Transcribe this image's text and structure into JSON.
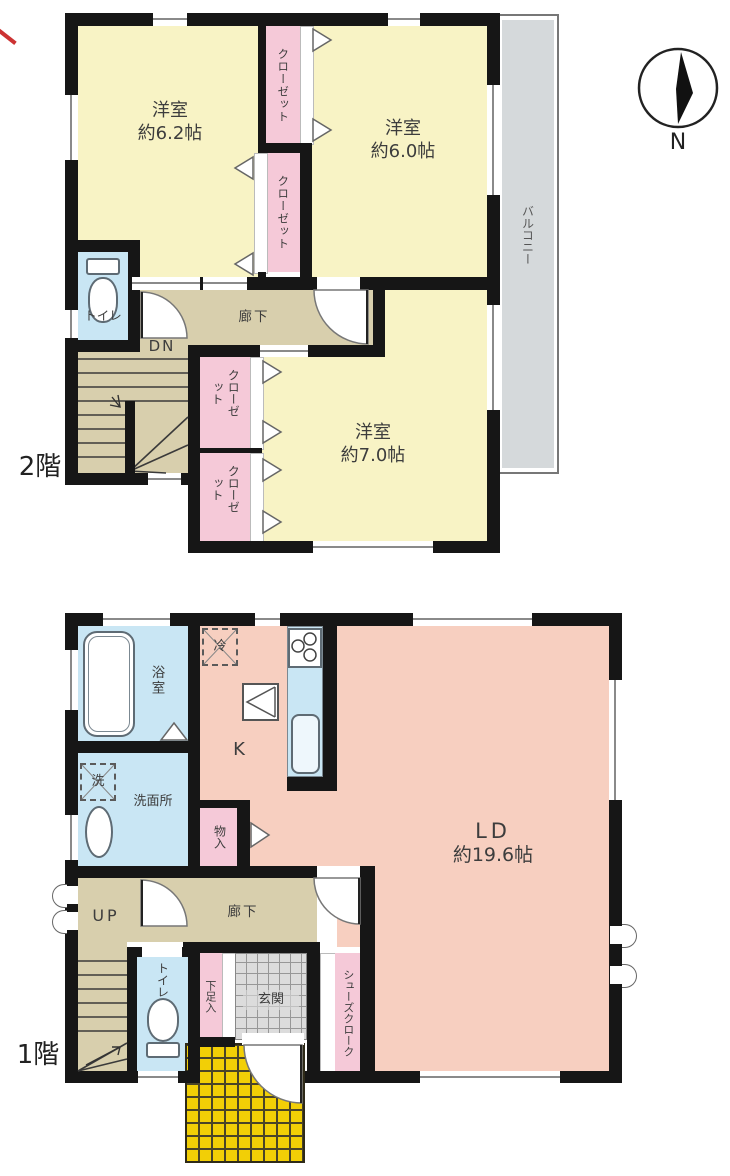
{
  "compass": {
    "label": "N"
  },
  "floor2": {
    "label": "2階",
    "room_62": {
      "name": "洋室",
      "size": "約6.2帖"
    },
    "room_60": {
      "name": "洋室",
      "size": "約6.0帖"
    },
    "room_70": {
      "name": "洋室",
      "size": "約7.0帖"
    },
    "closet_top_1": "クローゼット",
    "closet_top_2": "クローゼット",
    "closet_low_1": "クローゼット",
    "closet_low_2": "クローゼット",
    "toilet": "トイレ",
    "hallway": "廊下",
    "stairs_down": "DN",
    "balcony": "バルコニー"
  },
  "floor1": {
    "label": "1階",
    "bathroom": "浴室",
    "washer": "洗",
    "washroom": "洗面所",
    "fridge": "冷",
    "kitchen": "K",
    "storage": "物入",
    "living": {
      "name": "LD",
      "size": "約19.6帖"
    },
    "stairs_up": "UP",
    "hallway": "廊下",
    "toilet": "トイレ",
    "shoe_box": "下足入",
    "entrance": "玄関",
    "shoe_closet": "シューズクローク"
  },
  "colors": {
    "wall": "#161616",
    "room_yellow": "#f8f3c5",
    "closet_pink": "#f5c9d8",
    "corridor_tan": "#d8cfad",
    "water_blue": "#c9e6f4",
    "ld_salmon": "#f7cfc0",
    "balcony_gray": "#d5d9db",
    "porch_yellow": "#f2cf06",
    "entrance_gray": "#dcdcdc",
    "annotation_red": "#cc3333"
  }
}
